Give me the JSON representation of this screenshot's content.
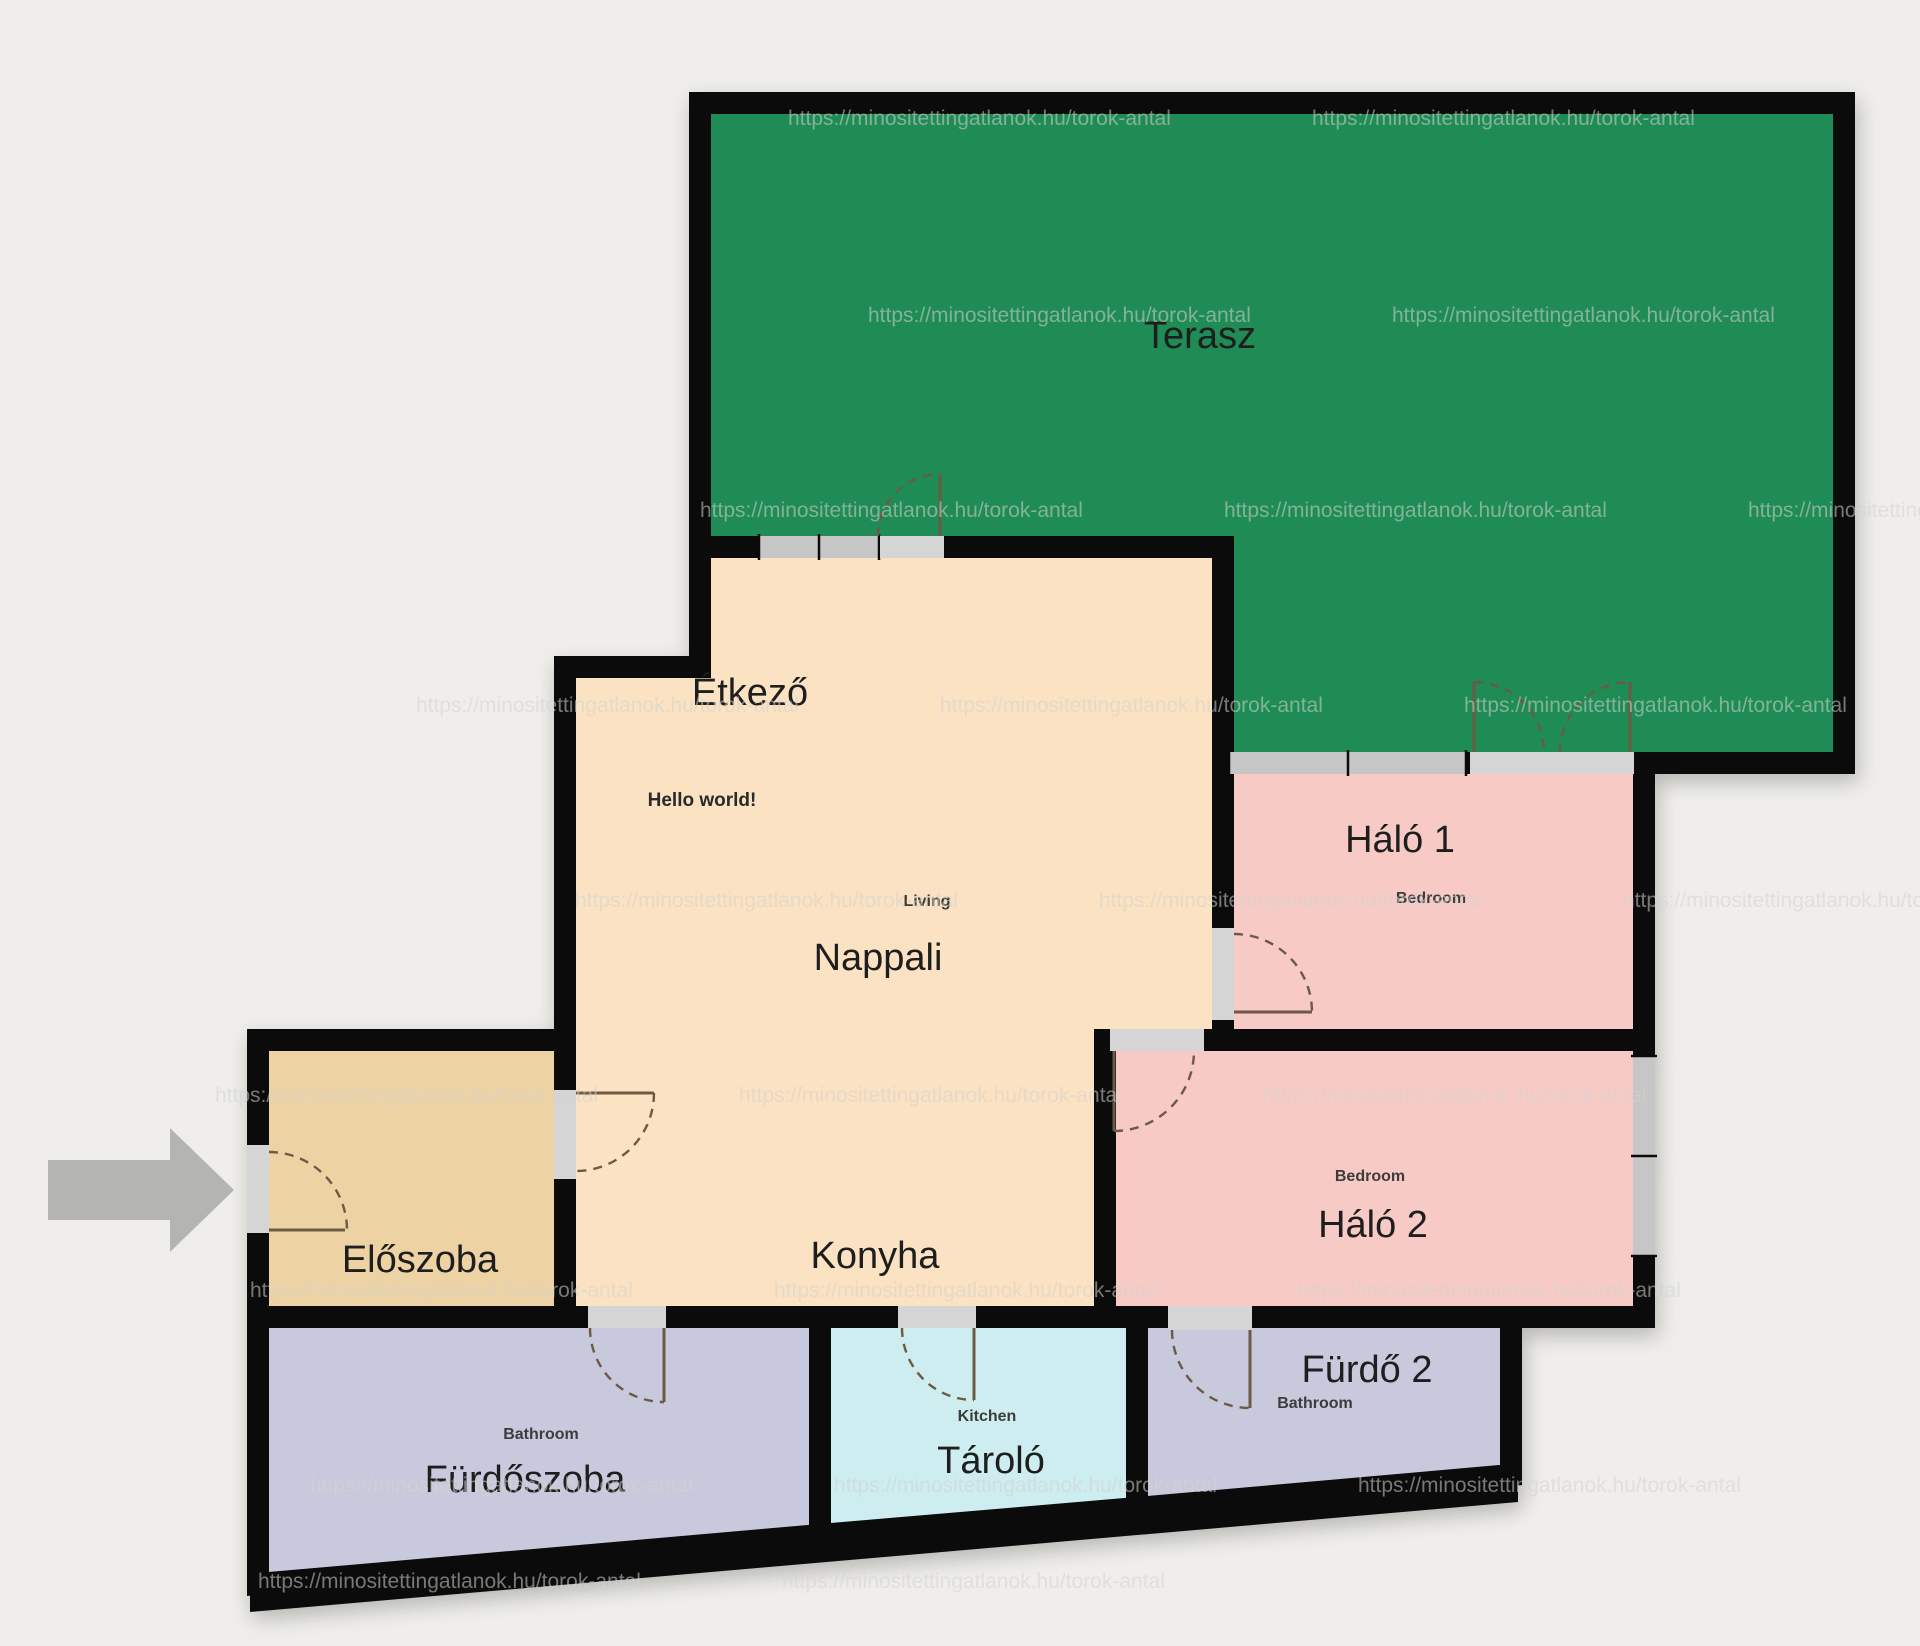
{
  "watermark": "https://minositettingatlanok.hu/torok-antal",
  "palette": {
    "background": "#efeeea",
    "wall": "#0b0b0b",
    "terrace": "#1f8b55",
    "living": "#fbe2c2",
    "hall": "#edd3a4",
    "bedroom": "#f7cac5",
    "bathroom": "#c9c9dd",
    "storage": "#cdedf0",
    "window": "#c6c6c6",
    "door_gap": "#d5d5d5",
    "arrow": "#b4b4b1"
  },
  "rooms": {
    "terasz": {
      "label": "Terasz"
    },
    "etkezo": {
      "label": "Étkező"
    },
    "nappali": {
      "label": "Nappali",
      "sublabel": "Living"
    },
    "konyha": {
      "label": "Konyha"
    },
    "eloszoba": {
      "label": "Előszoba"
    },
    "halo1": {
      "label": "Háló 1",
      "sublabel": "Bedroom"
    },
    "halo2": {
      "label": "Háló 2",
      "sublabel": "Bedroom"
    },
    "furdo2": {
      "label": "Fürdő 2",
      "sublabel": "Bathroom"
    },
    "tarolo": {
      "label": "Tároló",
      "sublabel": "Kitchen"
    },
    "furdoszoba": {
      "label": "Fürdőszoba",
      "sublabel": "Bathroom"
    }
  },
  "annotations": {
    "hello": "Hello world!"
  }
}
